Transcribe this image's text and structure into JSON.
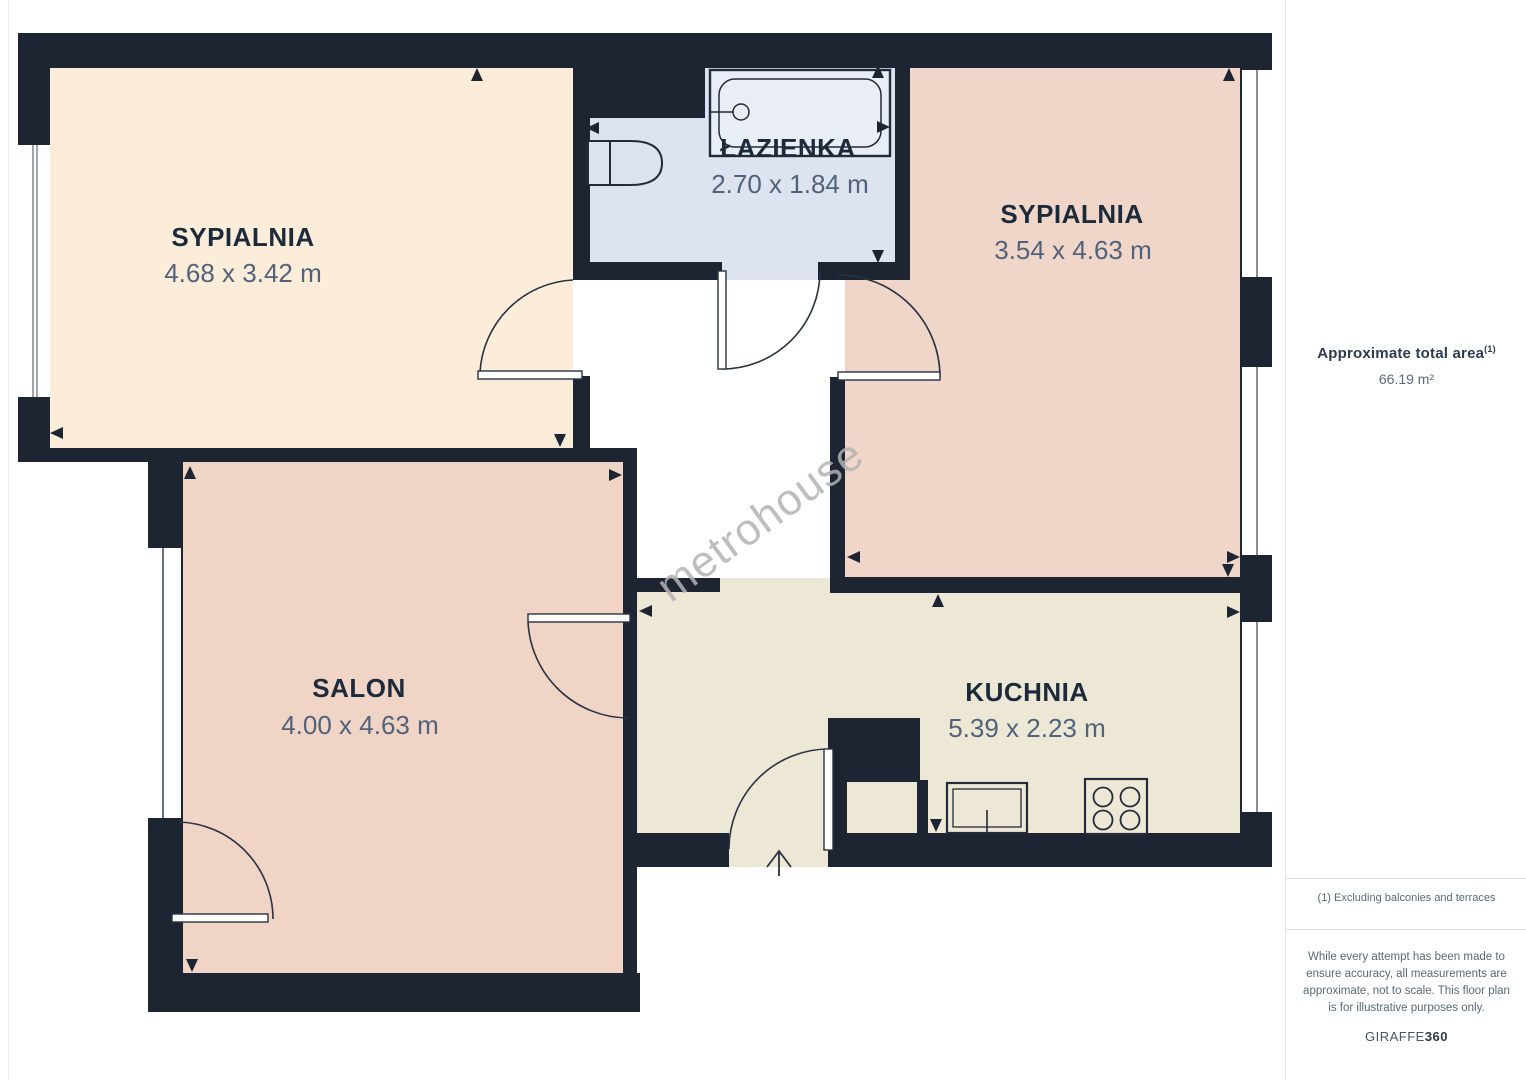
{
  "floor_plan": {
    "rooms": [
      {
        "id": "bedroom-1",
        "name": "SYPIALNIA",
        "dimensions": "4.68 x 3.42 m"
      },
      {
        "id": "bathroom",
        "name": "ŁAZIENKA",
        "dimensions": "2.70 x 1.84 m"
      },
      {
        "id": "bedroom-2",
        "name": "SYPIALNIA",
        "dimensions": "3.54 x 4.63 m"
      },
      {
        "id": "living-room",
        "name": "SALON",
        "dimensions": "4.00 x 4.63 m"
      },
      {
        "id": "kitchen",
        "name": "KUCHNIA",
        "dimensions": "5.39 x 2.23 m"
      }
    ],
    "watermark": "metrohouse",
    "colors": {
      "wall": "#1d2432",
      "bedroom1_floor": "#fcecda",
      "bedroom2_floor": "#f0d6c8",
      "living_room_floor": "#f0d5c7",
      "kitchen_floor": "#ede8d6",
      "bathroom_floor": "#dde3ef",
      "label_title": "#1c2a3a",
      "label_dims": "#51627a",
      "watermark_gray": "#b3b3b3"
    }
  },
  "sidebar": {
    "total_area_label": "Approximate total area",
    "total_area_footnote_marker": "(1)",
    "total_area_value": "66.19 m²",
    "footnote": "(1) Excluding balconies and terraces",
    "disclaimer": "While every attempt has been made to ensure accuracy, all measurements are approximate, not to scale. This floor plan is for illustrative purposes only.",
    "brand_name": "GIRAFFE",
    "brand_suffix": "360"
  }
}
